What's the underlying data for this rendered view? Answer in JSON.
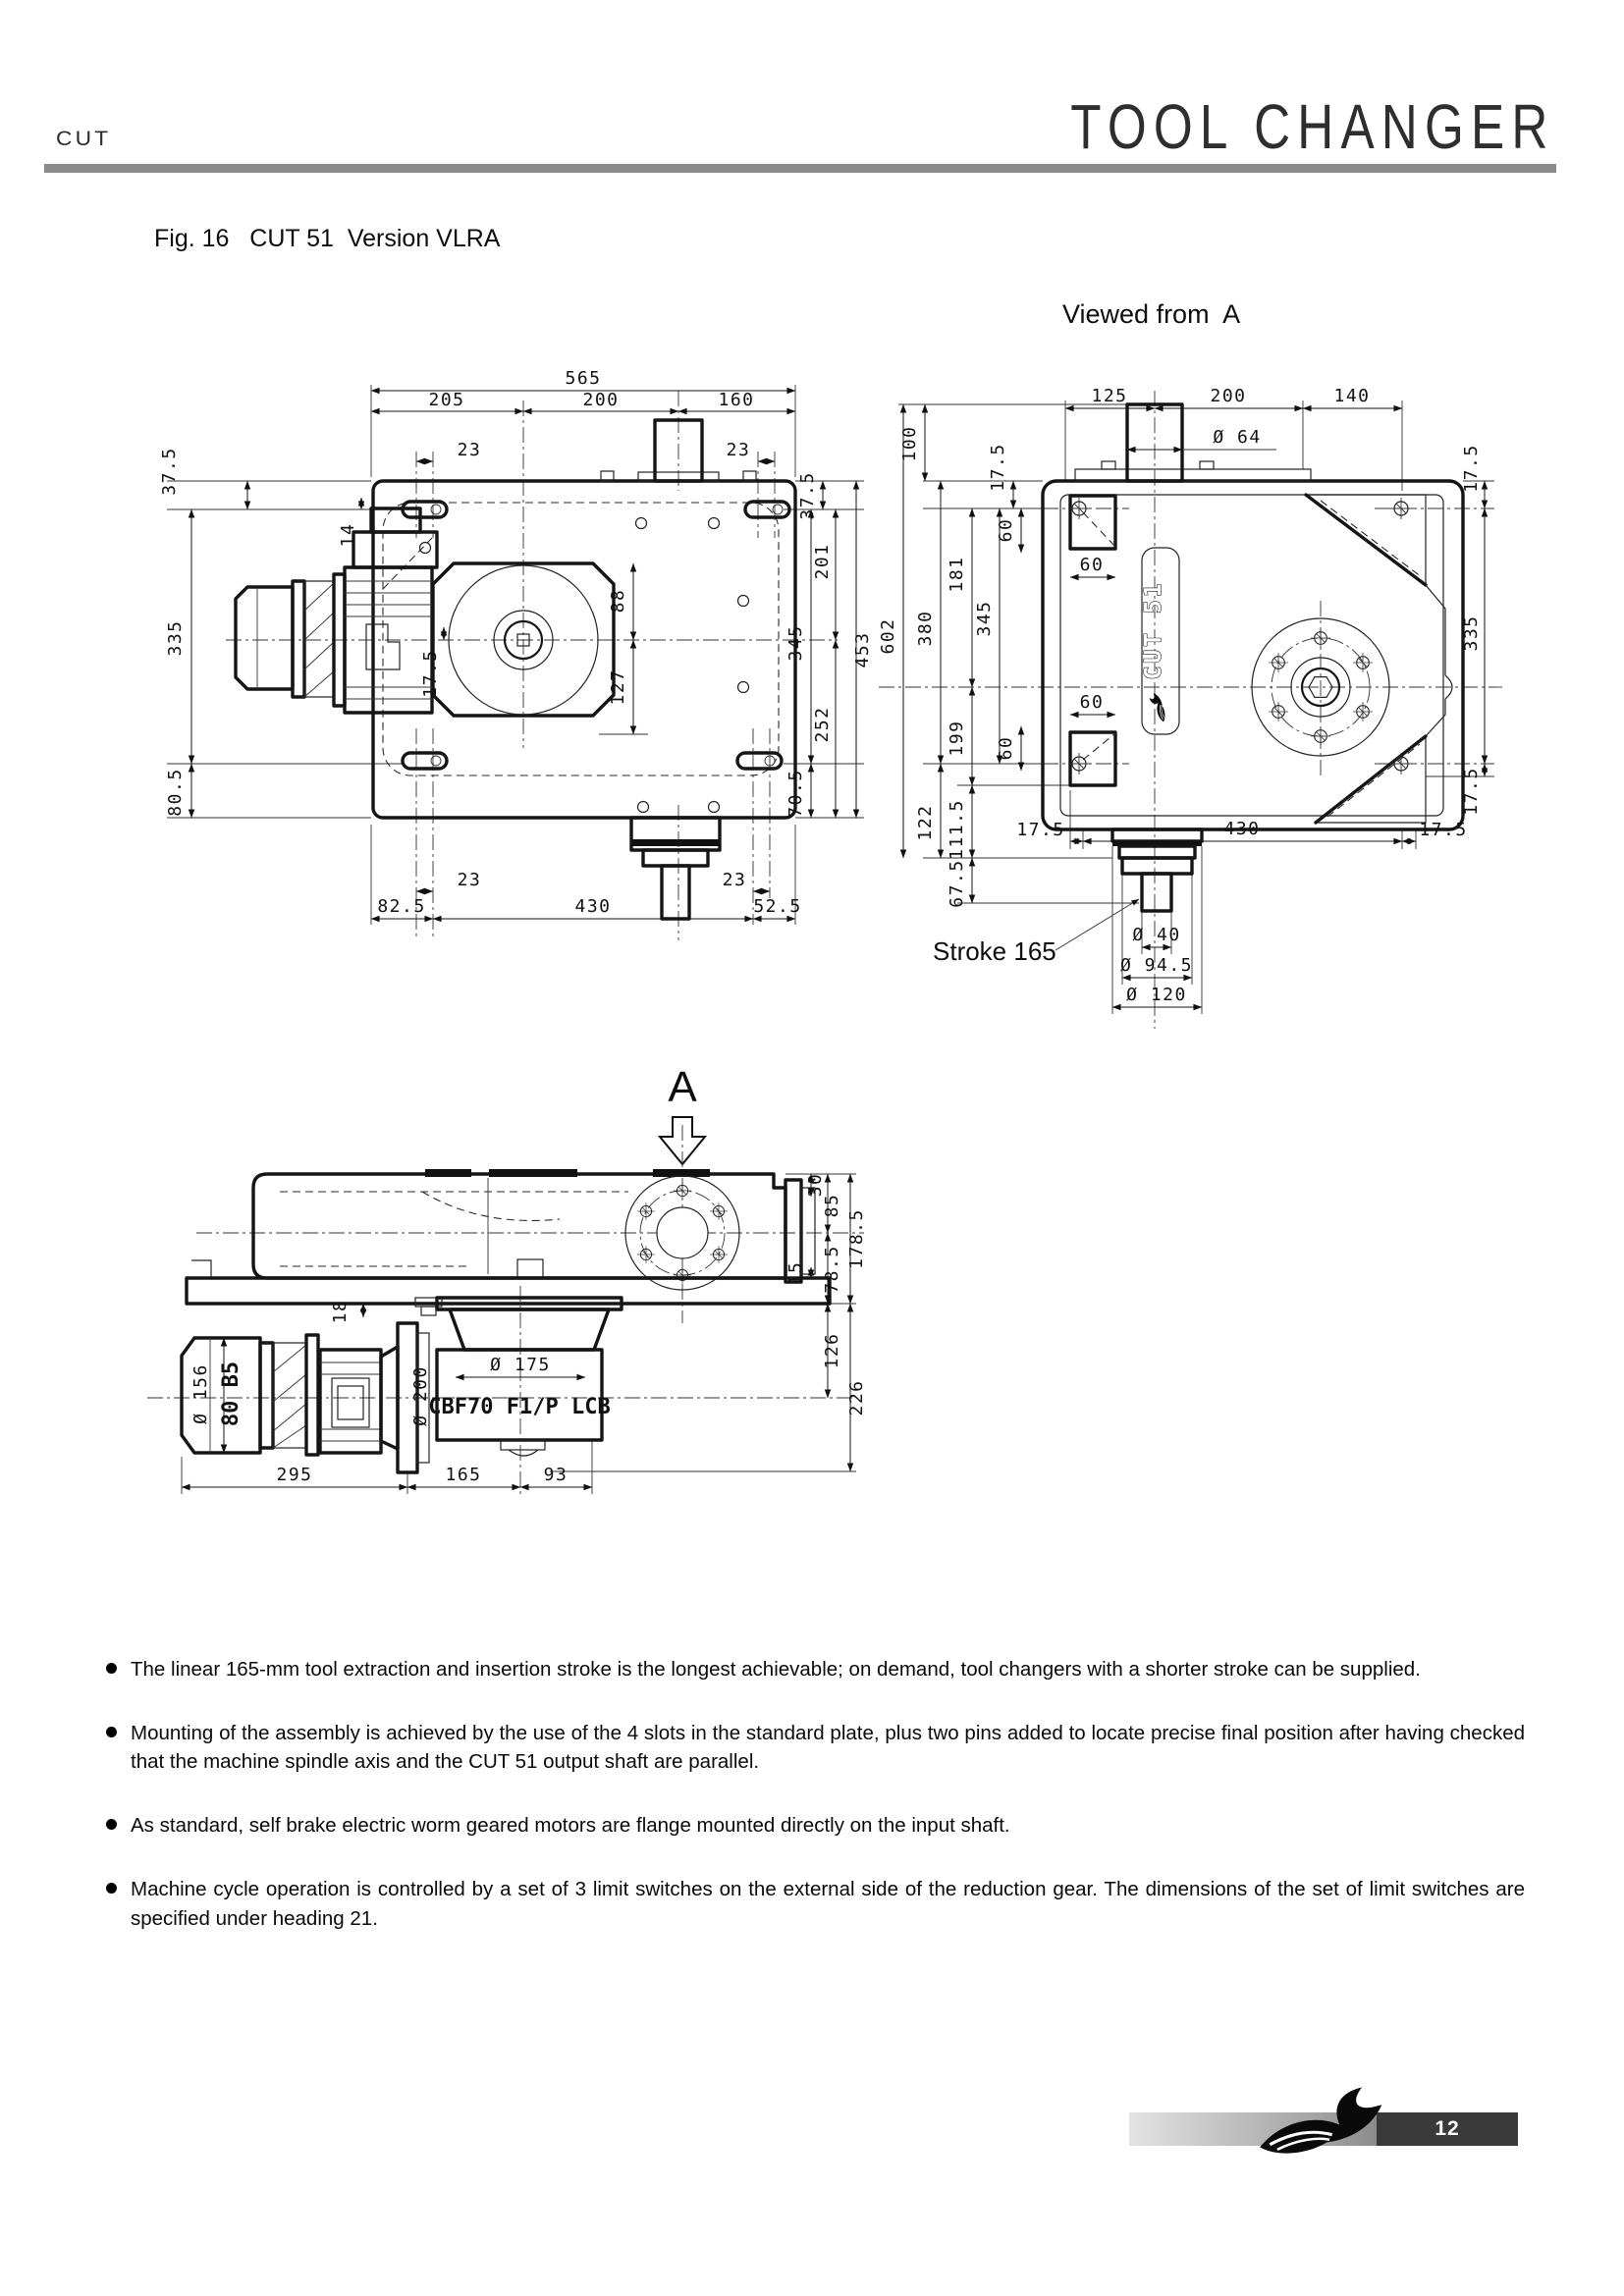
{
  "header": {
    "brand": "CUT",
    "title": "TOOL CHANGER"
  },
  "figure": {
    "caption": "Fig. 16   CUT 51  Version VLRA",
    "view_label": "Viewed from  A",
    "arrow_label": "A",
    "stroke_label": "Stroke 165",
    "logo_plate": "CUT 51",
    "motor_code": "CBF70 F1/P LCB",
    "motor_frame": "80 B5"
  },
  "dims": {
    "p565": "565",
    "p205": "205",
    "p200": "200",
    "p160": "160",
    "p23a": "23",
    "p23b": "23",
    "p23c": "23",
    "p23d": "23",
    "p37a": "37.5",
    "p37b": "37.5",
    "p14": "14",
    "p88": "88",
    "p127": "127",
    "p175": "17.5",
    "p335": "335",
    "p805": "80.5",
    "p825": "82.5",
    "p430": "430",
    "p525": "52.5",
    "p705": "70.5",
    "p252": "252",
    "p345": "345",
    "p453": "453",
    "p201": "201",
    "a125": "125",
    "a200": "200",
    "a140": "140",
    "a64": "Ø 64",
    "a100": "100",
    "a175a": "17.5",
    "a175b": "17.5",
    "a175c": "17.5",
    "a175d": "17.5",
    "a175e": "17.5",
    "a175f": "17.5",
    "a60a": "60",
    "a60b": "60",
    "a60c": "60",
    "a60d": "60",
    "a181": "181",
    "a345": "345",
    "a380": "380",
    "a602": "602",
    "a199": "199",
    "a1115": "111.5",
    "a122": "122",
    "a675": "67.5",
    "a430": "430",
    "a335": "335",
    "a40": "Ø 40",
    "a945": "Ø 94.5",
    "a120": "Ø 120",
    "s30": "30",
    "s85": "85",
    "s1785": "178.5",
    "s15": "15",
    "s785": "78.5",
    "s126": "126",
    "s226": "226",
    "s18": "18",
    "s156": "Ø 156",
    "s200": "Ø 200",
    "s175": "Ø 175",
    "s295": "295",
    "s165": "165",
    "s93": "93"
  },
  "bullets": [
    "The linear 165-mm tool extraction and insertion stroke is the longest achievable; on demand, tool changers with a shorter stroke can be supplied.",
    "Mounting of the assembly is achieved by the use of the 4 slots in the standard plate, plus two pins added to locate precise final position after having checked that the machine spindle axis and the CUT 51 output shaft are parallel.",
    "As standard, self brake electric worm geared motors are flange mounted directly on the input shaft.",
    "Machine cycle operation is controlled by a set of 3 limit switches on the external side of the reduction gear. The dimensions of the set of limit switches are specified under heading 21."
  ],
  "footer": {
    "page": "12"
  }
}
